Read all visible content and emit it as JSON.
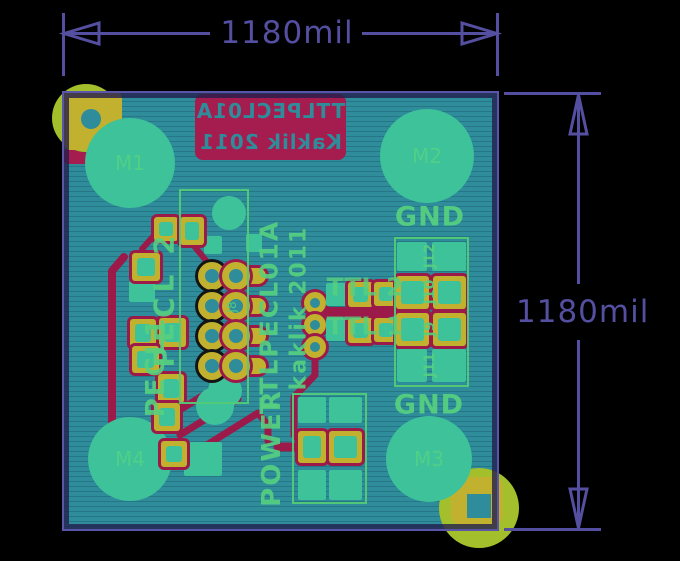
{
  "colors": {
    "background": "#000000",
    "dimension_purple": "#544fa0",
    "board_teal": "#2e8c9b",
    "board_border_purple": "#5a55a8",
    "copper_green": "#3ec29a",
    "silkscreen_green": "#57d07e",
    "smd_pad_yellow": "#c2b02f",
    "drill_yellow_green": "#a3bf2b",
    "bottom_silk_crimson": "#a51c4e",
    "trace_red": "#9c1a4a"
  },
  "dimensions": {
    "top": {
      "label": "1180mil"
    },
    "right": {
      "label": "1180mil"
    }
  },
  "board": {
    "silkscreen_bottom_mirrored": {
      "line1": "TTLPECL01A",
      "line2": "Kaklik 2011"
    },
    "mount_holes": [
      {
        "label": "M1"
      },
      {
        "label": "M2"
      },
      {
        "label": "M3"
      },
      {
        "label": "M4"
      }
    ],
    "labels": {
      "gnd_top": "GND",
      "gnd_bottom": "GND",
      "power": "POWER",
      "ttl_2": "TTL 2",
      "ttl_1": "TTL 1",
      "pecl_2": "PECL 2",
      "pecl_1": "PECL1",
      "ic_name": "TTLPECL01A",
      "ic_author": "kaklik 2011",
      "j8": "J8"
    },
    "right_connector": {
      "rows": [
        {
          "label": "J12"
        },
        {
          "label": "J10"
        },
        {
          "label": "J9"
        },
        {
          "label": "J11"
        }
      ]
    }
  }
}
